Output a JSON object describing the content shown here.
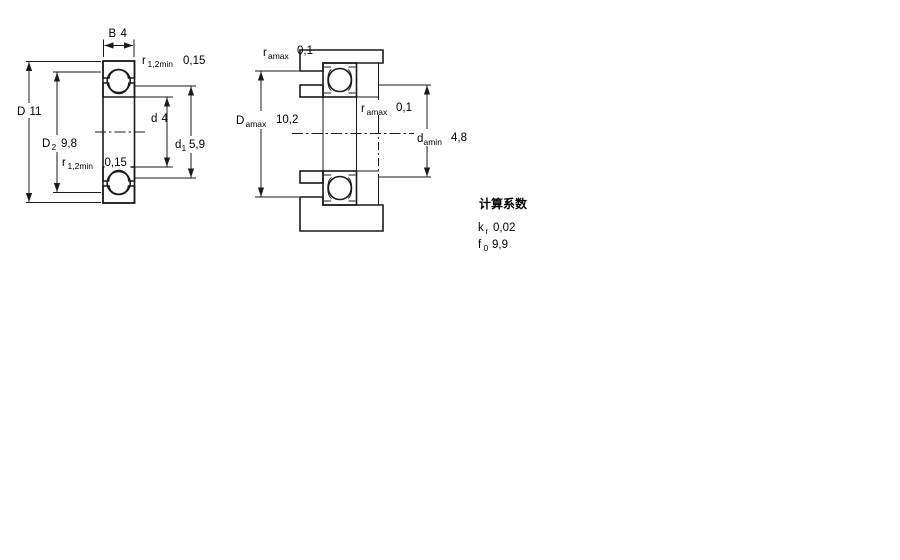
{
  "colors": {
    "section_fill": "#a9c2d8",
    "line": "#1a1a1a",
    "background": "#ffffff"
  },
  "fig1": {
    "dim_B": {
      "main": "B",
      "value": "4"
    },
    "dim_D": {
      "main": "D",
      "value": "11"
    },
    "dim_D2": {
      "main": "D",
      "sub": "2",
      "value": "9,8"
    },
    "dim_d": {
      "main": "d",
      "value": "4"
    },
    "dim_d1": {
      "main": "d",
      "sub": "1",
      "value": "5,9"
    },
    "dim_r_top": {
      "main": "r",
      "sub": "1,2min",
      "value": "0,15"
    },
    "dim_r_mid": {
      "main": "r",
      "sub": "1,2min",
      "value": "0,15"
    }
  },
  "fig2": {
    "dim_ra_top": {
      "main": "r",
      "sub": "amax",
      "value": "0,1"
    },
    "dim_Da": {
      "main": "D",
      "sub": "amax",
      "value": "10,2"
    },
    "dim_ra_mid": {
      "main": "r",
      "sub": "amax",
      "value": "0,1"
    },
    "dim_da": {
      "main": "d",
      "sub": "amin",
      "value": "4,8"
    }
  },
  "calculation_factors": {
    "title": "计算系数",
    "kr": {
      "main": "k",
      "sub": "r",
      "value": "0,02"
    },
    "f0": {
      "main": "f",
      "sub": "0",
      "value": "9,9"
    }
  }
}
